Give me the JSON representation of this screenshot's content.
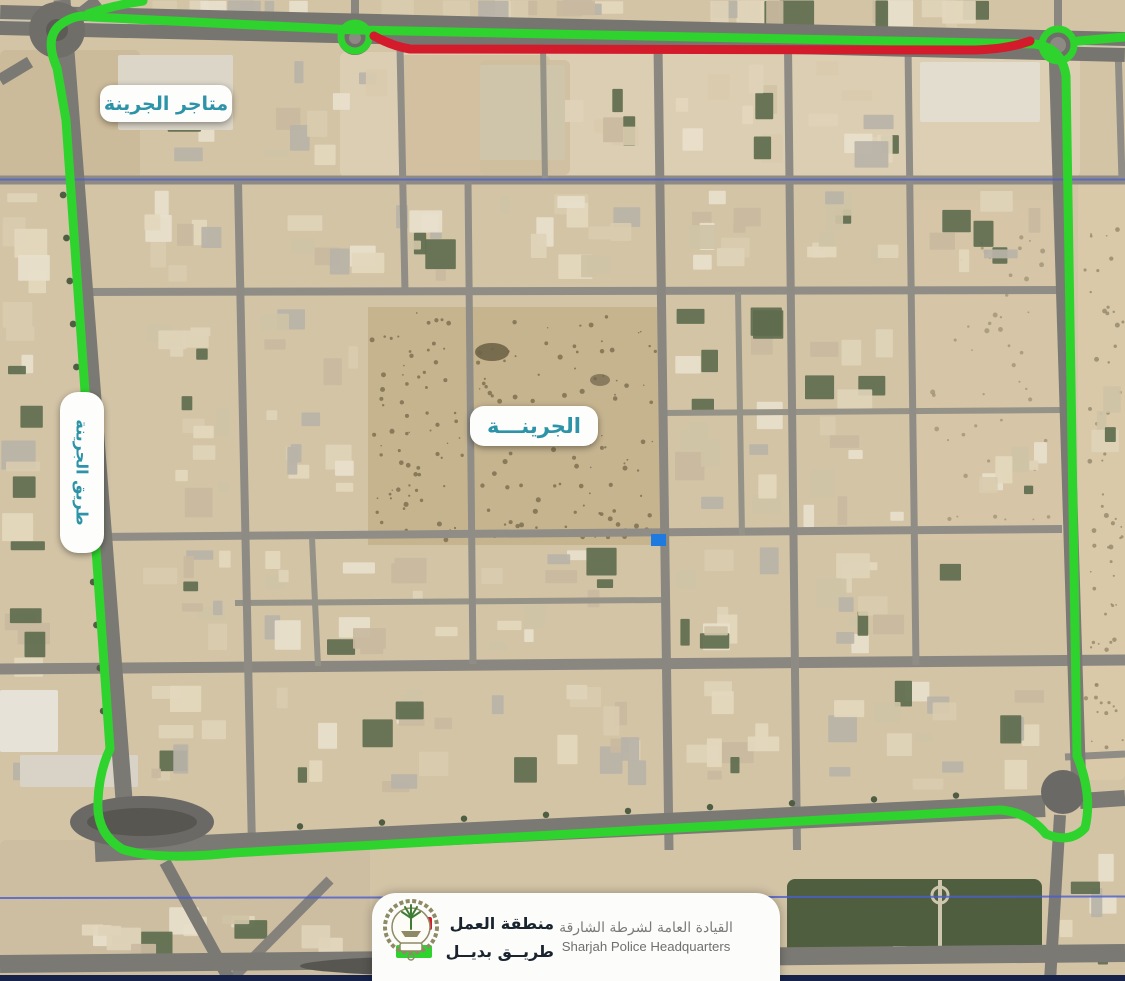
{
  "labels": {
    "shops": "متاجر الجرينة",
    "district": "الجرينـــة",
    "road": "طريق الجرينة"
  },
  "legend": {
    "work_zone": "منطقة العمل",
    "alt_route": "طريــق بديــل"
  },
  "logo": {
    "arabic": "القيادة العامة لشرطة الشارقة",
    "english": "Sharjah Police Headquarters"
  },
  "colors": {
    "route_green": "#2ed32e",
    "work_red": "#d41b2c",
    "label_text": "#2d93a8",
    "legend_text": "#19242f",
    "boundary_blue": "#4a5ed0",
    "bottom_bar": "#16224a",
    "marker_blue": "#1f7ae0"
  }
}
